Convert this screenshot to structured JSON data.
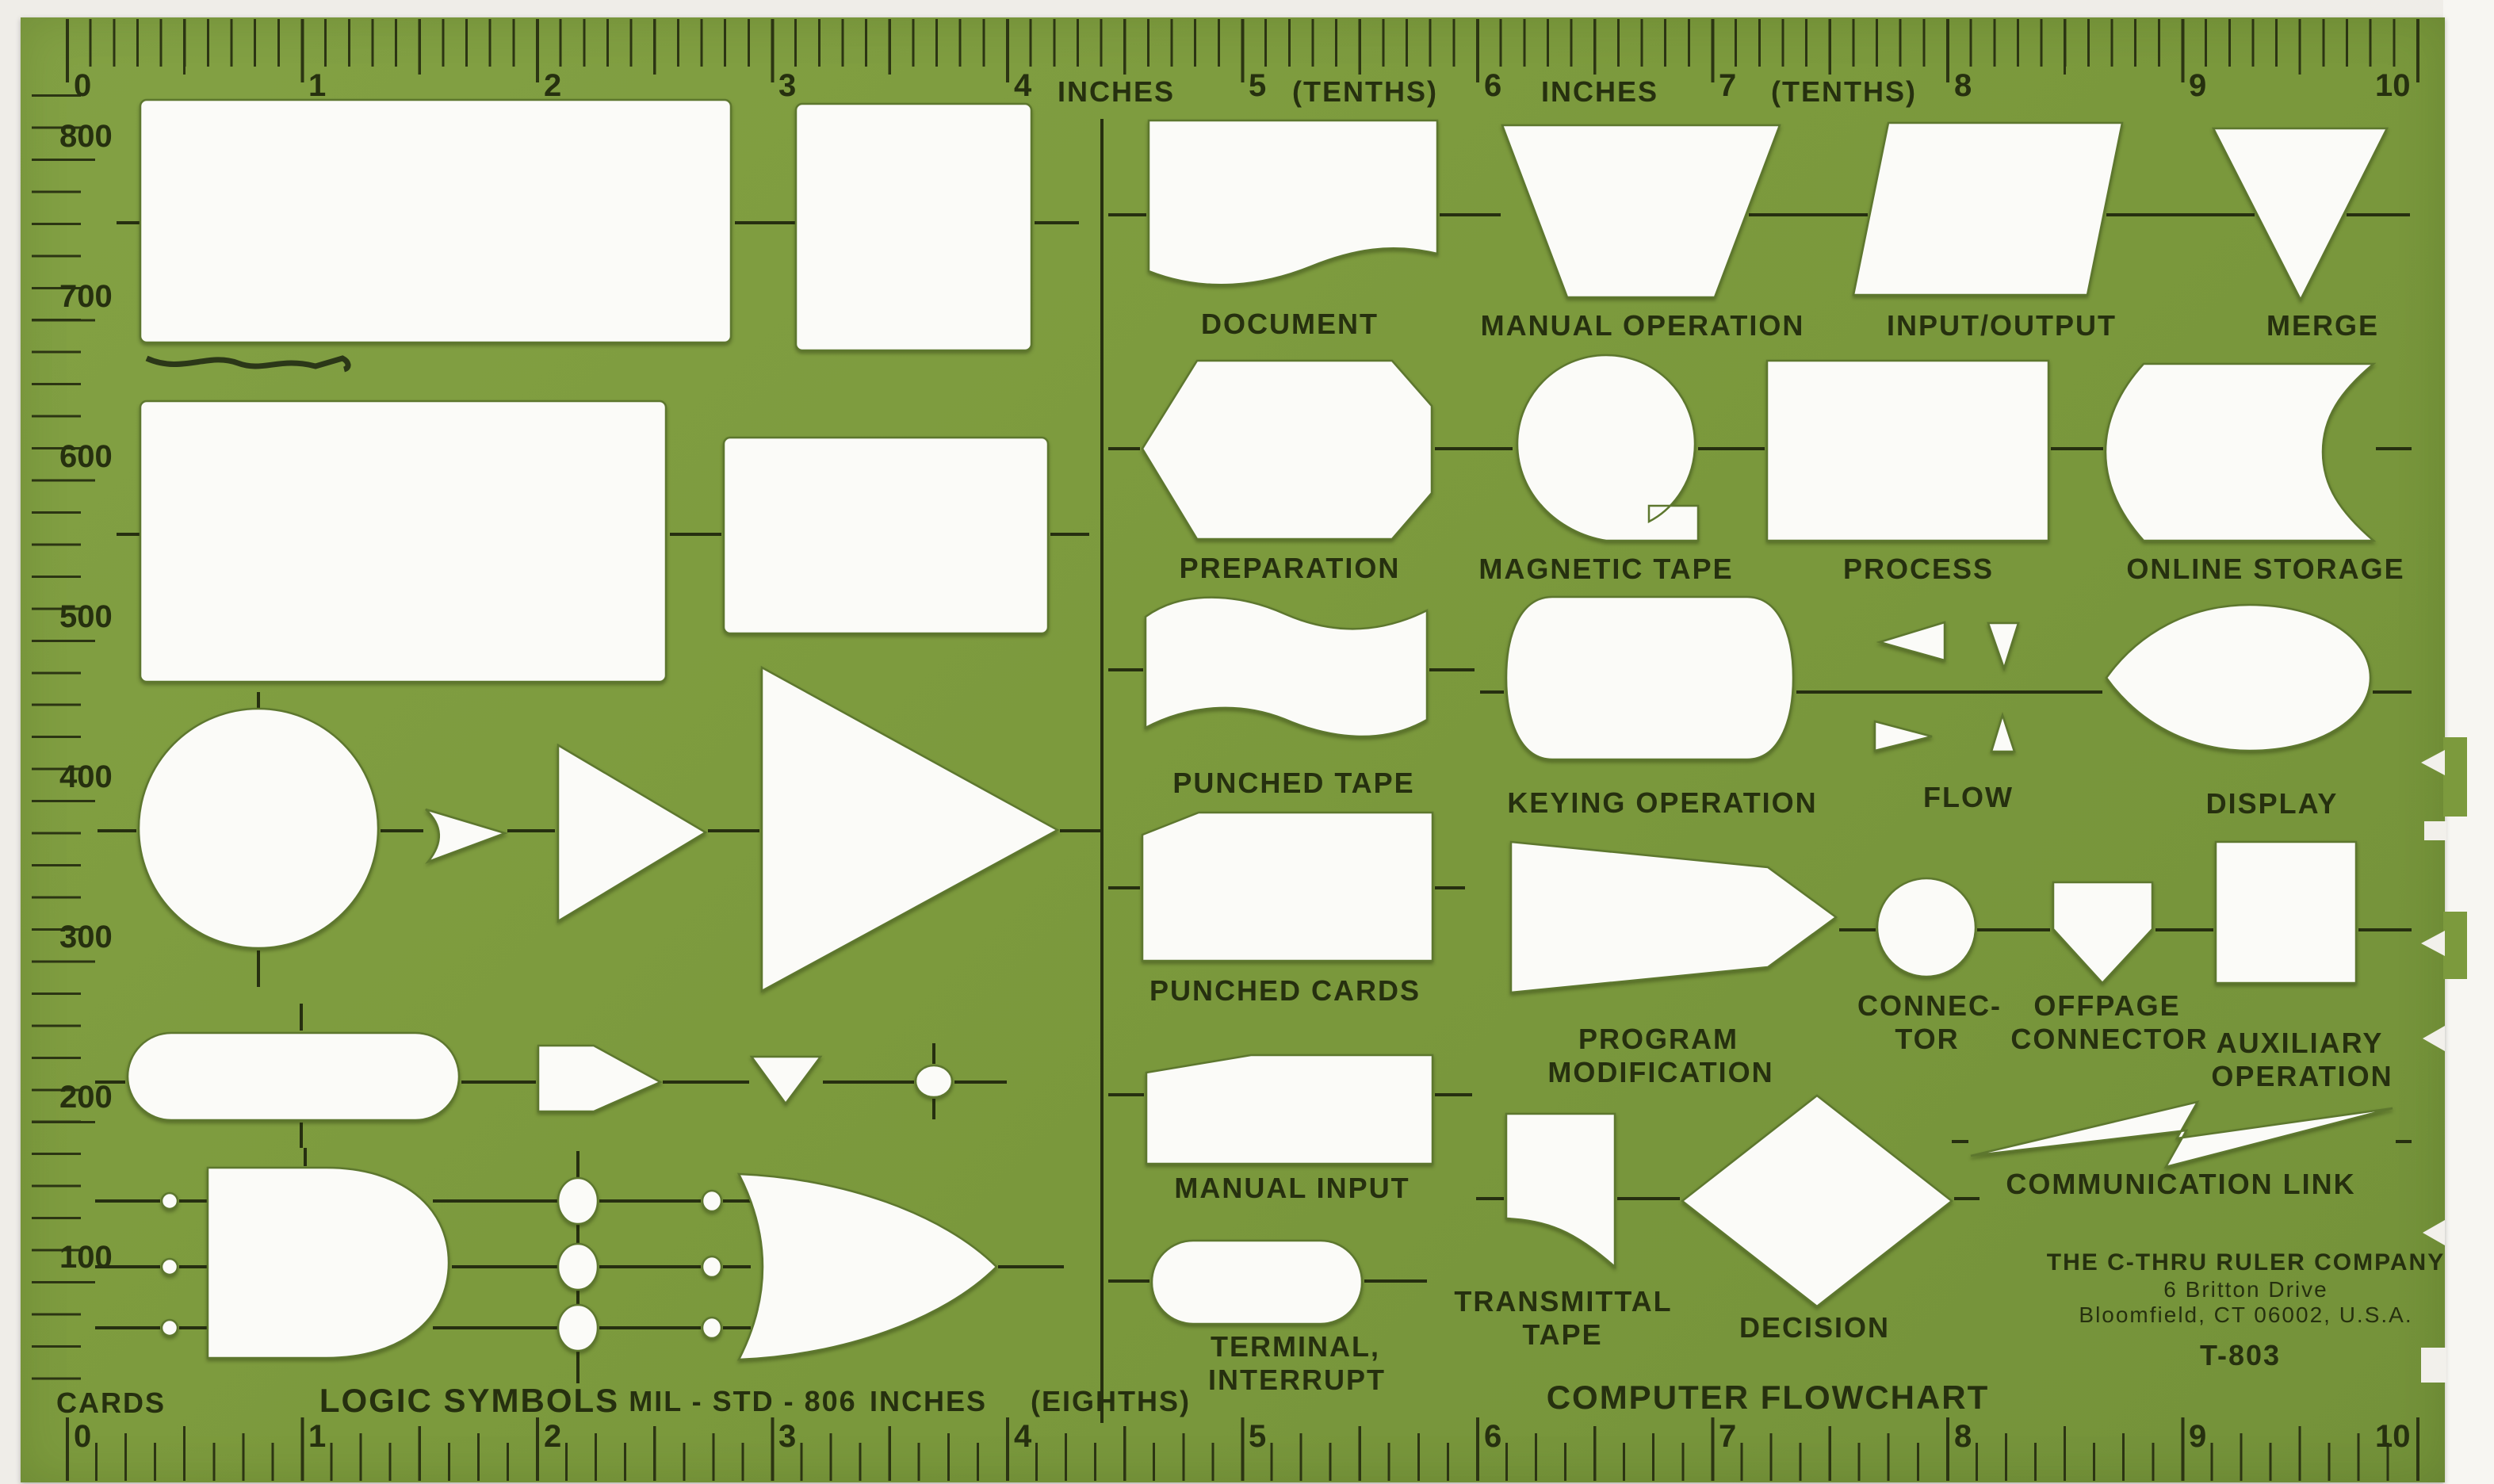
{
  "template": {
    "title": "COMPUTER FLOWCHART",
    "model": "T-803",
    "standard": "MIL - STD - 806",
    "logic_title": "LOGIC SYMBOLS",
    "bottom_units": "INCHES",
    "bottom_subunits": "(EIGHTHS)"
  },
  "colors": {
    "plastic_green": "#7c9a3d",
    "ink": "#26300f",
    "cutout_white": "#fbfbf8",
    "scan_background": "#efede8"
  },
  "top_ruler": {
    "numbers": [
      "0",
      "1",
      "2",
      "3",
      "4",
      "5",
      "6",
      "7",
      "8",
      "9",
      "10"
    ],
    "labels": [
      "INCHES",
      "(TENTHS)",
      "INCHES",
      "(TENTHS)"
    ]
  },
  "bottom_ruler": {
    "numbers": [
      "0",
      "1",
      "2",
      "3",
      "4",
      "5",
      "6",
      "7",
      "8",
      "9",
      "10"
    ]
  },
  "left_ruler": {
    "label": "CARDS",
    "numbers": [
      "800",
      "700",
      "600",
      "500",
      "400",
      "300",
      "200",
      "100"
    ]
  },
  "symbols": [
    {
      "label": "DOCUMENT",
      "shape": "rectangle-wavy-bottom"
    },
    {
      "label": "MANUAL OPERATION",
      "shape": "trapezoid"
    },
    {
      "label": "INPUT/OUTPUT",
      "shape": "parallelogram"
    },
    {
      "label": "MERGE",
      "shape": "inverted-triangle"
    },
    {
      "label": "PREPARATION",
      "shape": "elongated-hexagon"
    },
    {
      "label": "MAGNETIC TAPE",
      "shape": "circle-with-tab"
    },
    {
      "label": "PROCESS",
      "shape": "rectangle"
    },
    {
      "label": "ONLINE STORAGE",
      "shape": "curved-cylinder"
    },
    {
      "label": "PUNCHED TAPE",
      "shape": "wavy-band"
    },
    {
      "label": "KEYING OPERATION",
      "shape": "rounded-barrel"
    },
    {
      "label": "FLOW",
      "shape": "arrowheads"
    },
    {
      "label": "DISPLAY",
      "shape": "pointed-oval"
    },
    {
      "label": "PUNCHED CARDS",
      "shape": "rectangle-clipped-corner"
    },
    {
      "label": "PROGRAM",
      "label2": "MODIFICATION",
      "shape": "pointed-pennant"
    },
    {
      "label": "CONNEC-",
      "label2": "TOR",
      "shape": "small-circle"
    },
    {
      "label": "OFFPAGE",
      "label2": "CONNECTOR",
      "shape": "home-plate-pentagon"
    },
    {
      "label": "AUXILIARY",
      "label2": "OPERATION",
      "shape": "square"
    },
    {
      "label": "MANUAL INPUT",
      "shape": "sloped-top-quad"
    },
    {
      "label": "TRANSMITTAL",
      "label2": "TAPE",
      "shape": "flag"
    },
    {
      "label": "DECISION",
      "shape": "diamond"
    },
    {
      "label": "COMMUNICATION LINK",
      "shape": "lightning-bolt"
    },
    {
      "label": "TERMINAL,",
      "label2": "INTERRUPT",
      "shape": "stadium"
    }
  ],
  "company": {
    "name": "THE C-THRU RULER COMPANY",
    "address_line1": "6 Britton Drive",
    "address_line2": "Bloomfield, CT 06002, U.S.A.",
    "model": "T-803"
  }
}
